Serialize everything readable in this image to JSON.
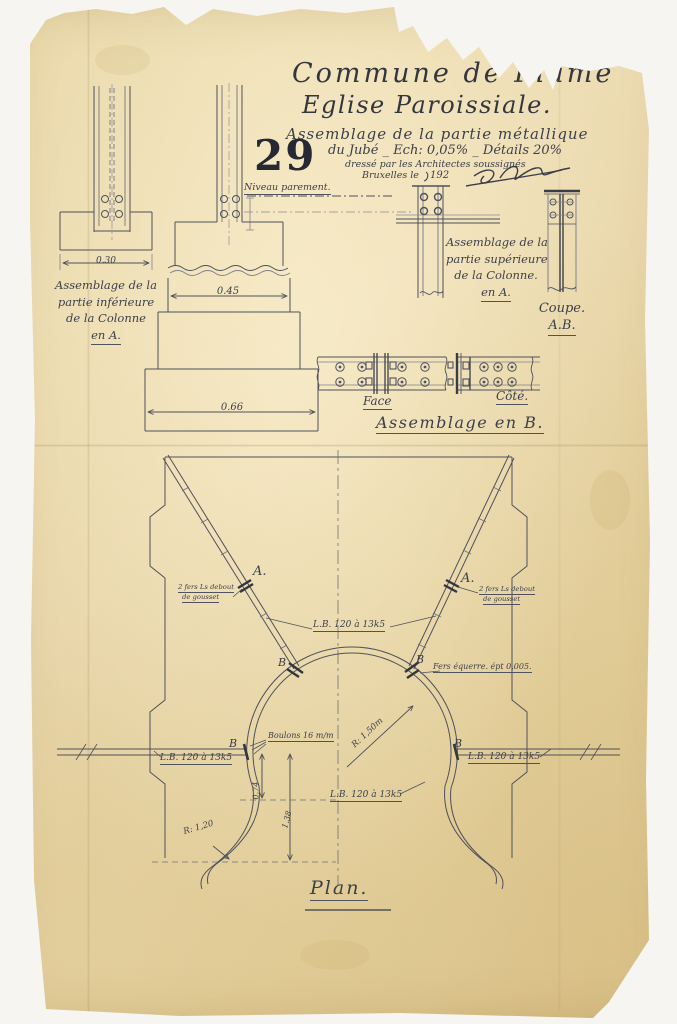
{
  "page": {
    "sheet_number": "29",
    "archive_number": "359"
  },
  "header": {
    "title1": "Commune de Flame",
    "title2": "Eglise Paroissiale.",
    "sub1": "Assemblage de la partie métallique",
    "sub2": "du Jubé _ Ech: 0,05% _ Détails 20%",
    "sub3": "dressé par les Architectes soussignés",
    "sub4": "Bruxelles le",
    "sub5": "192"
  },
  "details": {
    "niveau": "Niveau parement.",
    "dim_030": "0.30",
    "dim_045": "0.45",
    "dim_066": "0.66",
    "cap_inf": [
      "Assemblage de la",
      "partie inférieure",
      "de la Colonne",
      "en A."
    ],
    "cap_sup": [
      "Assemblage de la",
      "partie supérieure",
      "de la Colonne.",
      "en A."
    ],
    "coupe1": "Coupe.",
    "coupe2": "A.B.",
    "face": "Face",
    "cote": "Côté.",
    "assemblage_b": "Assemblage en B."
  },
  "plan": {
    "title": "Plan.",
    "marker_a": "A.",
    "marker_b": "B",
    "note_fers1": "2 fers Ls debout",
    "note_fers2": "de gousset",
    "lb": "L.B. 120 à 13k5",
    "fers_equerre": "Fers équerre. épt 0,005.",
    "boulons": "Boulons 16 m/m",
    "r150": "R: 1,50m",
    "r120": "R: 1,20",
    "dim_074": "0.74",
    "dim_138": "1.38"
  }
}
